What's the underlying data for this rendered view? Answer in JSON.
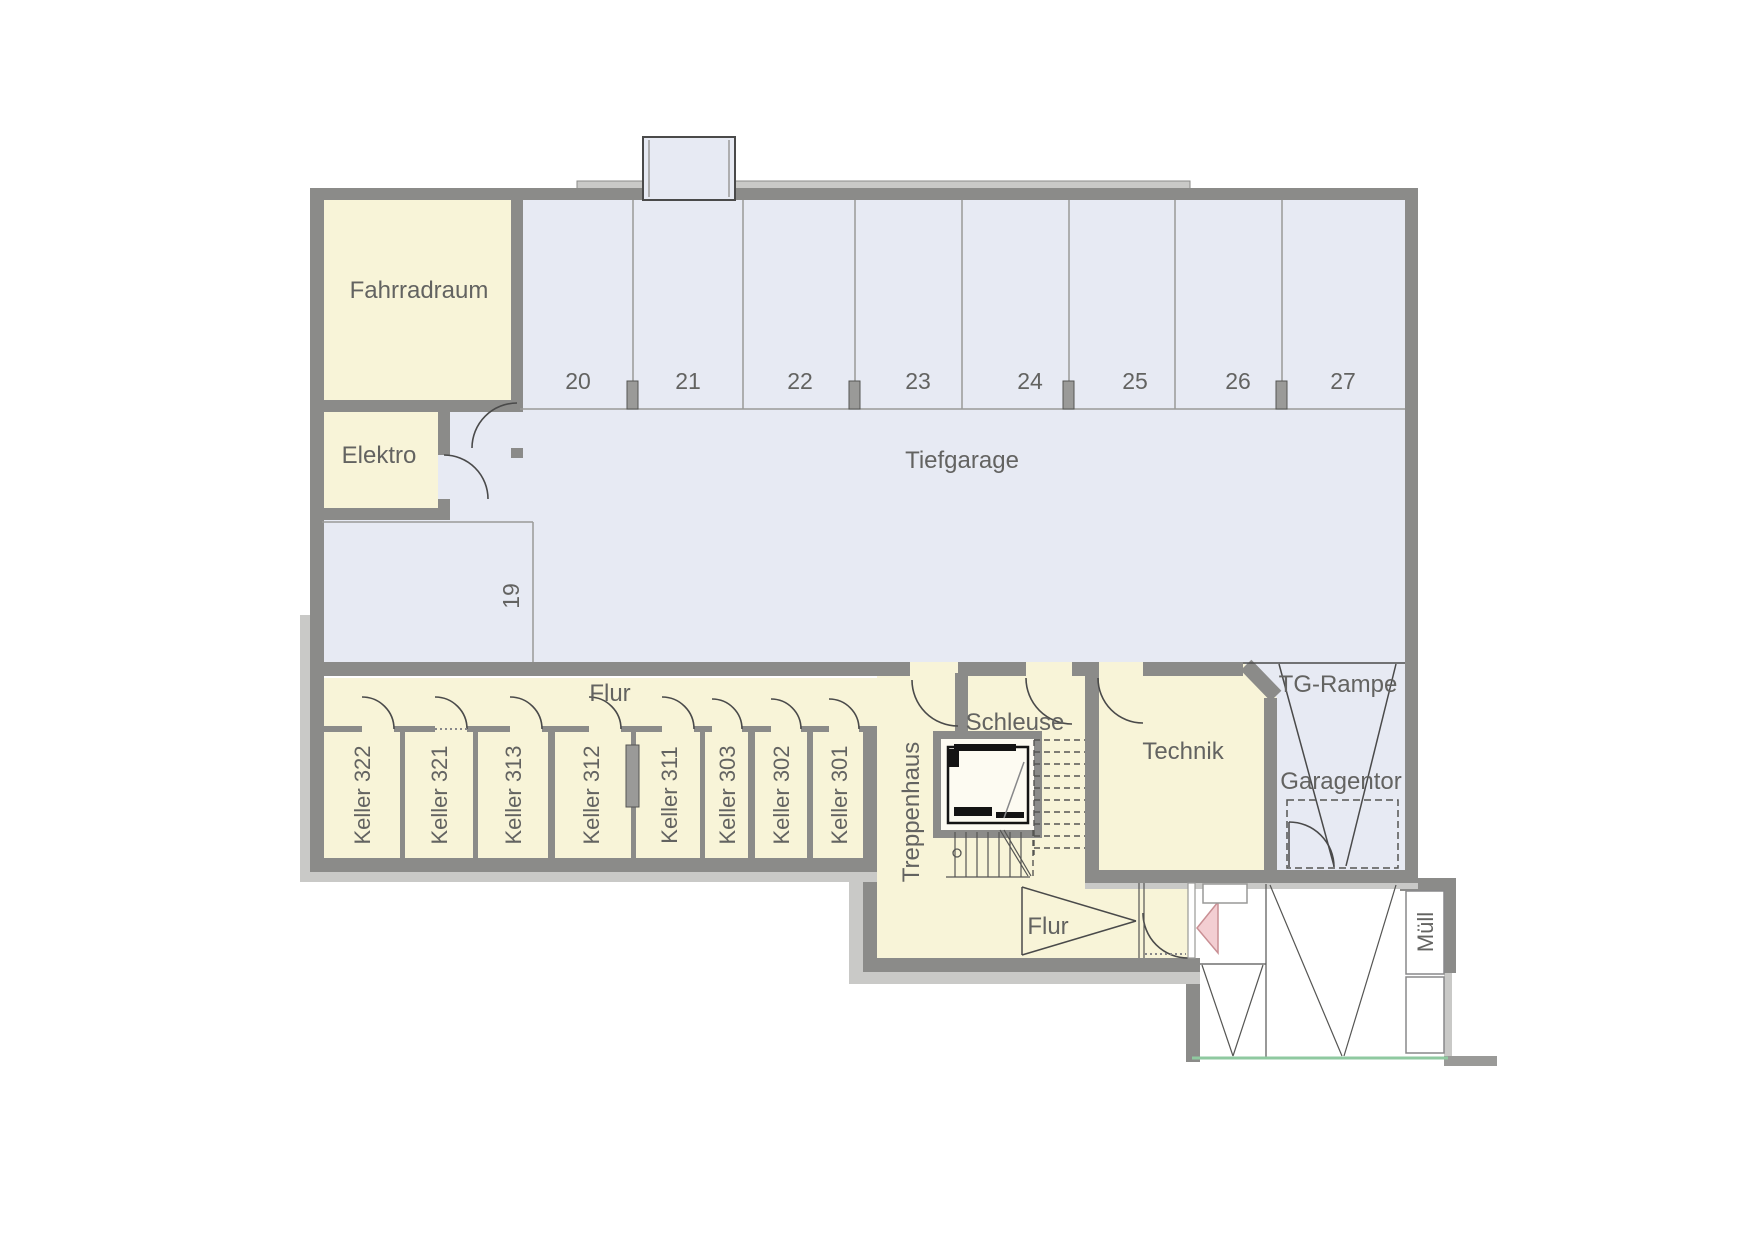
{
  "plan": {
    "title": "Tiefgarage Untergeschoss Grundriss",
    "labels": {
      "fahrradraum": "Fahrradraum",
      "elektro": "Elektro",
      "tiefgarage": "Tiefgarage",
      "flur_top": "Flur",
      "treppenhaus": "Treppenhaus",
      "schleuse": "Schleuse",
      "technik": "Technik",
      "tg_rampe": "TG-Rampe",
      "garagentor": "Garagentor",
      "flur_bottom": "Flur",
      "muell": "Müll"
    },
    "parking_spots": [
      "19",
      "20",
      "21",
      "22",
      "23",
      "24",
      "25",
      "26",
      "27"
    ],
    "keller_rooms": [
      "Keller 322",
      "Keller 321",
      "Keller 313",
      "Keller 312",
      "Keller 311",
      "Keller 303",
      "Keller 302",
      "Keller 301"
    ],
    "colors": {
      "wall_gray": "#8b8b89",
      "outer_shell_gray": "#c9c9c7",
      "room_yellow": "#f8f4d8",
      "garage_floor_blue": "#e7eaf3",
      "line_dark": "#4a4a4a",
      "label_gray": "#636361",
      "entrance_pink": "#f3ced2",
      "terrain_green": "#8fc9a0"
    }
  }
}
